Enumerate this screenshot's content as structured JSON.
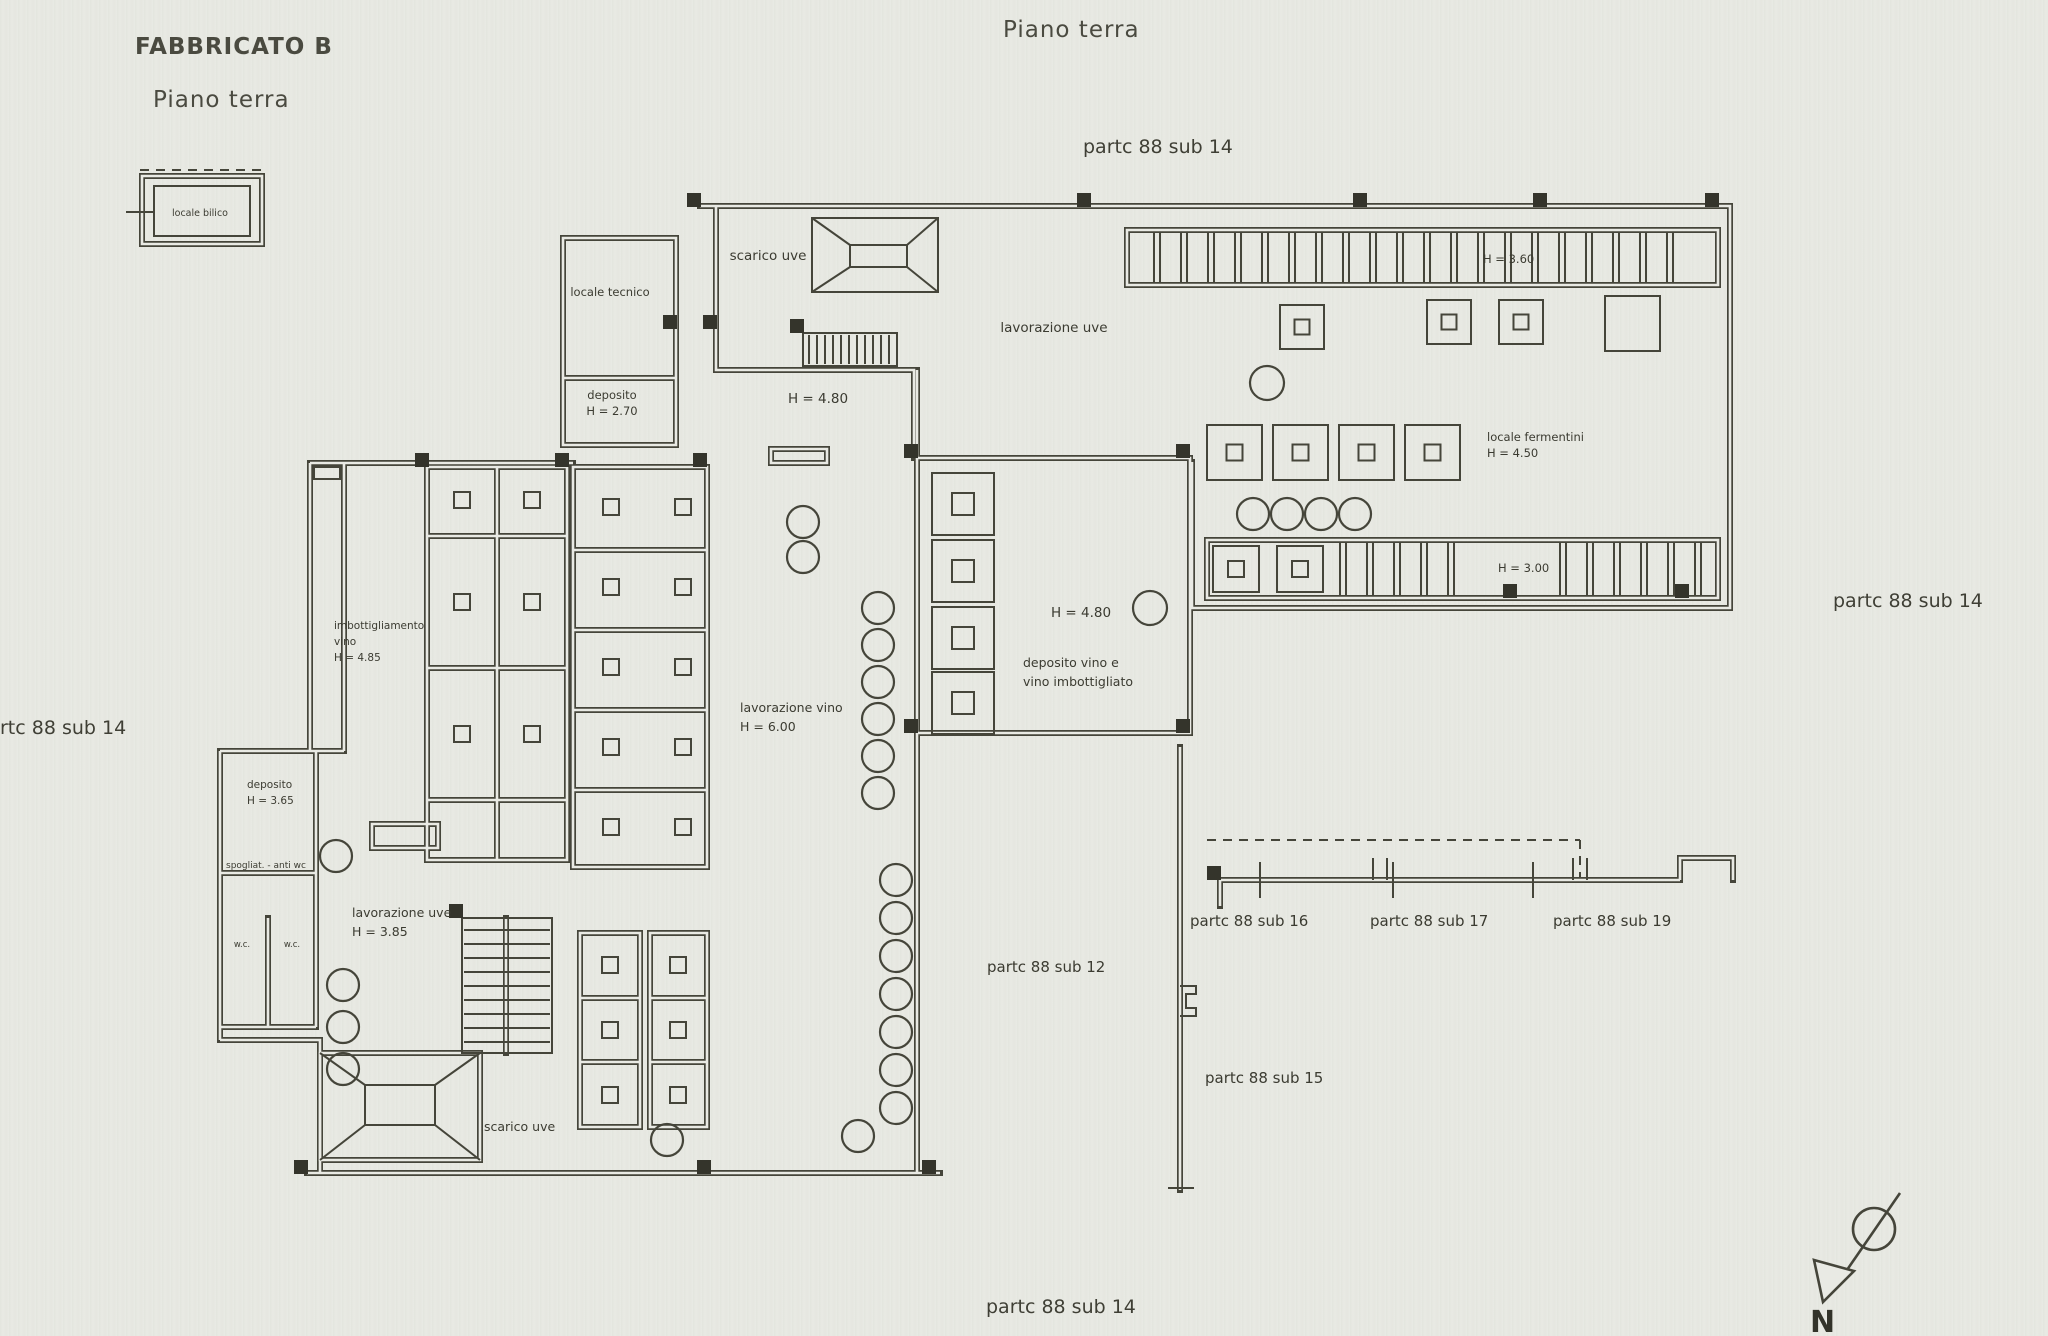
{
  "page": {
    "background": "#e9eae4",
    "ink": "#45453a"
  },
  "header": {
    "building": "FABBRICATO B",
    "floor_left": "Piano terra",
    "floor_top": "Piano terra"
  },
  "parcels": {
    "top": "partc 88 sub 14",
    "right": "partc 88 sub 14",
    "left": "rtc 88 sub 14",
    "bottom": "partc 88 sub 14",
    "sub16": "partc 88 sub 16",
    "sub17": "partc 88 sub 17",
    "sub19": "partc 88 sub 19",
    "sub12": "partc 88 sub 12",
    "sub15": "partc 88 sub 15"
  },
  "rooms": {
    "locale_bilico": "locale bilico",
    "scarico_uve_top": "scarico uve",
    "locale_tecnico": "locale tecnico",
    "deposito_nord_1": "deposito",
    "deposito_nord_2": "H = 2.70",
    "h_480_top": "H = 4.80",
    "lavorazione_uve_top": "lavorazione uve",
    "h_360": "H = 3.60",
    "fermentini_1": "locale fermentini",
    "fermentini_2": "H = 4.50",
    "h_300": "H = 3.00",
    "h_480_mid": "H = 4.80",
    "deposito_vino_1": "deposito  vino e",
    "deposito_vino_2": "vino imbottigliato",
    "lavorazione_vino_1": "lavorazione vino",
    "lavorazione_vino_2": "H = 6.00",
    "imbott_1": "imbottigliamento",
    "imbott_2": "vino",
    "imbott_3": "H = 4.85",
    "deposito_ovest_1": "deposito",
    "deposito_ovest_2": "H = 3.65",
    "spogliatoio": "spogliat. - anti wc",
    "wc_1": "w.c.",
    "wc_2": "w.c.",
    "lavorazione_uve_low_1": "lavorazione uve",
    "lavorazione_uve_low_2": "H = 3.85",
    "scarico_uve_bottom": "scarico uve"
  },
  "compass": {
    "north": "N"
  }
}
